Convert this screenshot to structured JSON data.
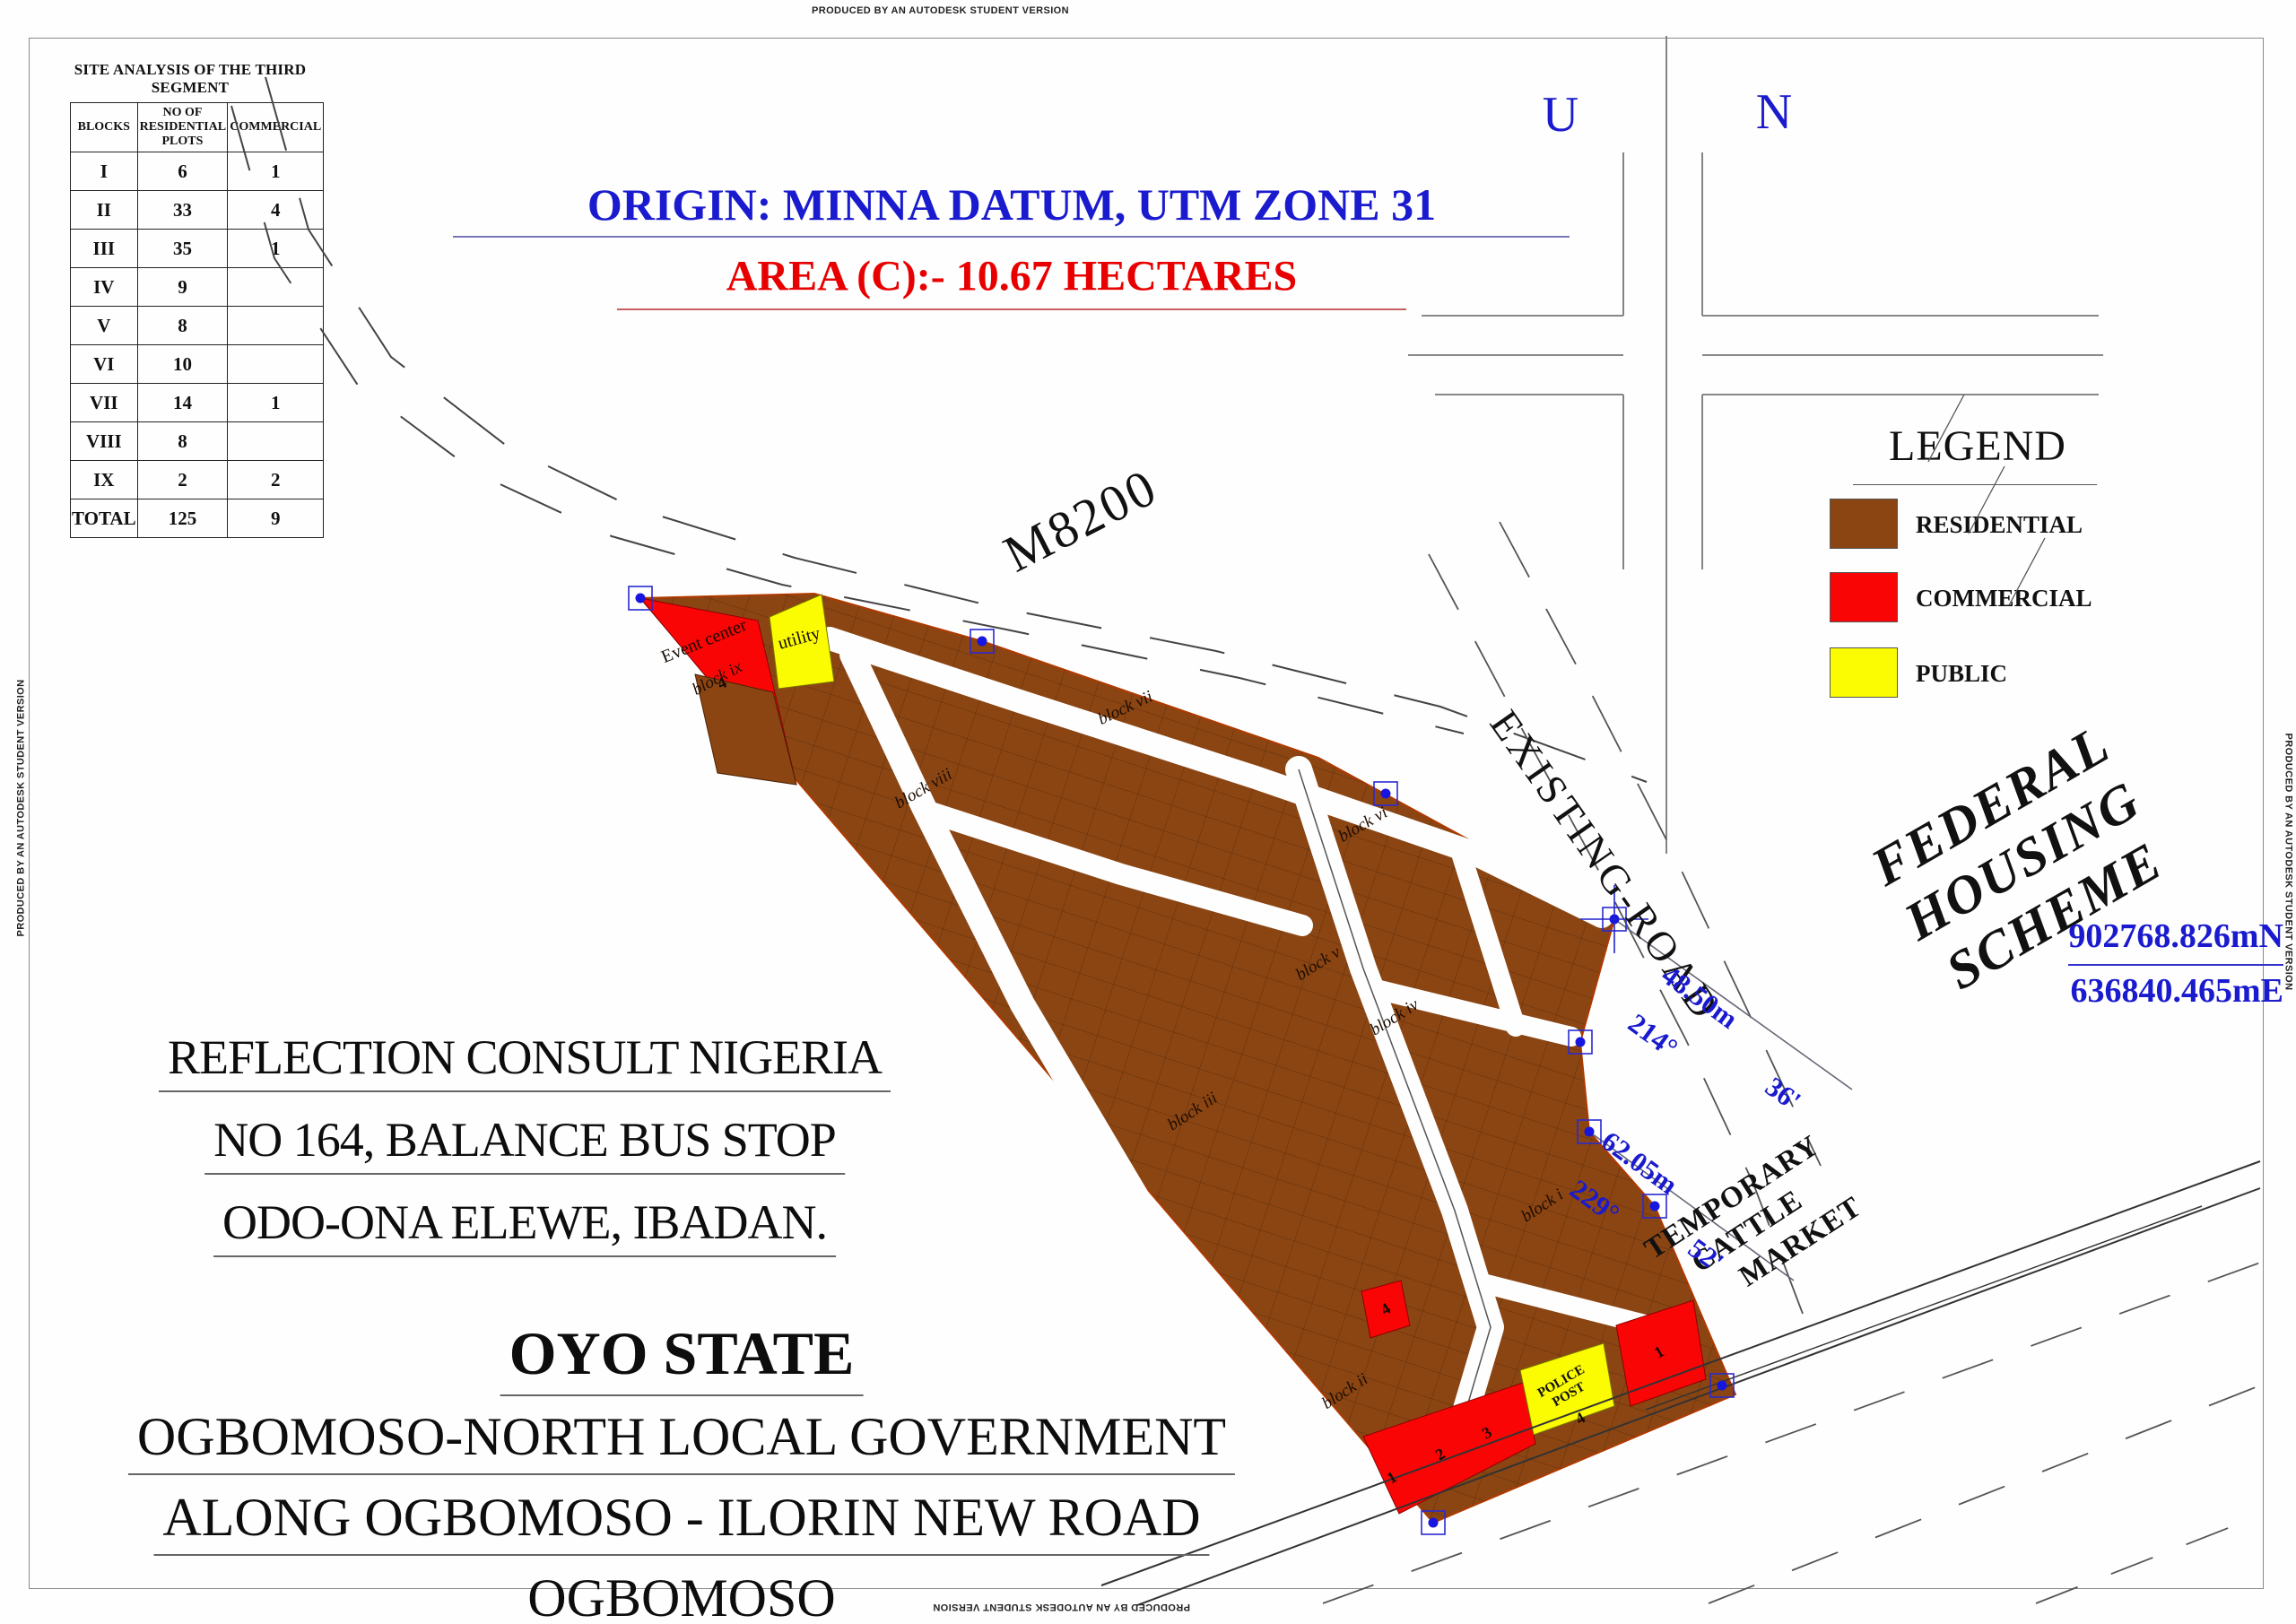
{
  "watermark": {
    "text": "PRODUCED BY AN AUTODESK STUDENT VERSION"
  },
  "table": {
    "title": "SITE ANALYSIS OF THE THIRD SEGMENT",
    "headers": [
      "BLOCKS",
      "NO OF RESIDENTIAL PLOTS",
      "COMMERCIAL"
    ],
    "rows": [
      [
        "I",
        "6",
        "1"
      ],
      [
        "II",
        "33",
        "4"
      ],
      [
        "III",
        "35",
        "1"
      ],
      [
        "IV",
        "9",
        ""
      ],
      [
        "V",
        "8",
        ""
      ],
      [
        "VI",
        "10",
        ""
      ],
      [
        "VII",
        "14",
        "1"
      ],
      [
        "VIII",
        "8",
        ""
      ],
      [
        "IX",
        "2",
        "2"
      ],
      [
        "TOTAL",
        "125",
        "9"
      ]
    ]
  },
  "header": {
    "origin": "ORIGIN: MINNA DATUM, UTM ZONE 31",
    "area": "AREA (C):- 10.67 HECTARES"
  },
  "compass": {
    "left": "U",
    "right": "N"
  },
  "road_labels": {
    "m8200": "M8200",
    "existing_road": "EXISTING-ROAD"
  },
  "scheme_label": {
    "lines": [
      "FEDERAL",
      "HOUSING",
      "SCHEME"
    ]
  },
  "cattle_market": {
    "lines": [
      "TEMPORARY",
      "CATTLE",
      "MARKET"
    ]
  },
  "legend": {
    "title": "LEGEND",
    "items": [
      {
        "label": "RESIDENTIAL",
        "color": "#8B4513"
      },
      {
        "label": "COMMERCIAL",
        "color": "#FA0505"
      },
      {
        "label": "PUBLIC",
        "color": "#FBFB02"
      }
    ]
  },
  "survey": {
    "northing": "902768.826mN",
    "easting": "636840.465mE",
    "bearings": [
      {
        "distance": "48.50m",
        "degrees": "214°",
        "minutes": "36'"
      },
      {
        "distance": "62.05m",
        "degrees": "229°",
        "minutes": "52'"
      }
    ]
  },
  "site": {
    "block_labels": [
      {
        "label": "block i"
      },
      {
        "label": "block ii"
      },
      {
        "label": "block iii"
      },
      {
        "label": "block iv"
      },
      {
        "label": "block v"
      },
      {
        "label": "block vi"
      },
      {
        "label": "block vii"
      },
      {
        "label": "block viii"
      },
      {
        "label": "block ix"
      }
    ],
    "special_labels": {
      "event_center": "Event center",
      "event_plot": "4",
      "utility": "utility",
      "police_line1": "POLICE",
      "police_line2": "POST",
      "police_plot": "4"
    },
    "plot_numbers": {
      "strip_1": "1",
      "strip_2": "2",
      "strip_3": "3",
      "commercial_right": "1",
      "commercial_mid": "4"
    }
  },
  "consultant": {
    "lines": [
      "REFLECTION CONSULT NIGERIA",
      "NO 164, BALANCE BUS STOP",
      "ODO-ONA ELEWE, IBADAN."
    ]
  },
  "location": {
    "title": "OYO STATE",
    "lines": [
      "OGBOMOSO-NORTH LOCAL GOVERNMENT",
      "ALONG OGBOMOSO - ILORIN NEW ROAD",
      "OGBOMOSO"
    ]
  },
  "colors": {
    "residential": "#8B4513",
    "commercial": "#FA0505",
    "public": "#FBFB02",
    "blue_text": "#1a1ace",
    "red_text": "#e80000"
  }
}
